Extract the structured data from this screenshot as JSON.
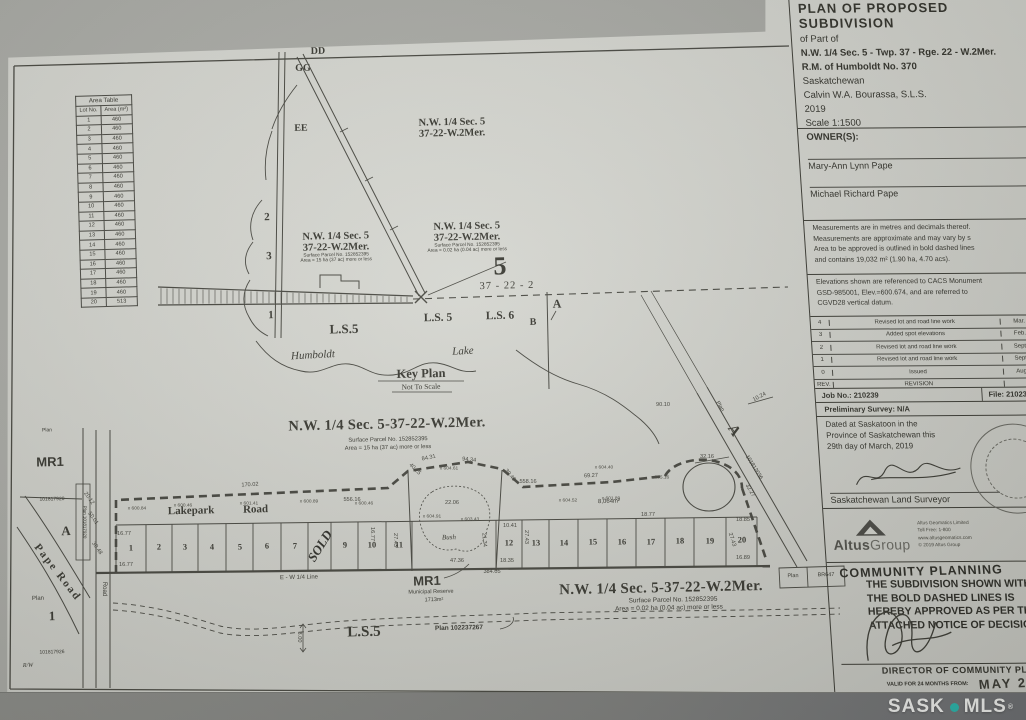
{
  "photo": {
    "watermark_sask": "SASK",
    "watermark_mls": "MLS",
    "watermark_reg": "®"
  },
  "area_table": {
    "title": "Area Table",
    "col_lot": "Lot No.",
    "col_area": "Area (m²)",
    "rows": [
      [
        "1",
        "460"
      ],
      [
        "2",
        "460"
      ],
      [
        "3",
        "460"
      ],
      [
        "4",
        "460"
      ],
      [
        "5",
        "460"
      ],
      [
        "6",
        "460"
      ],
      [
        "7",
        "460"
      ],
      [
        "8",
        "460"
      ],
      [
        "9",
        "460"
      ],
      [
        "10",
        "460"
      ],
      [
        "11",
        "460"
      ],
      [
        "12",
        "460"
      ],
      [
        "13",
        "460"
      ],
      [
        "14",
        "460"
      ],
      [
        "15",
        "460"
      ],
      [
        "16",
        "460"
      ],
      [
        "17",
        "460"
      ],
      [
        "18",
        "460"
      ],
      [
        "19",
        "460"
      ],
      [
        "20",
        "513"
      ]
    ]
  },
  "key_plan": {
    "dd": "DD",
    "gg": "GG",
    "ee": "EE",
    "n2": "2",
    "n3": "3",
    "n1": "1",
    "q_upper": [
      "N.W. 1/4 Sec. 5",
      "37-22-W.2Mer."
    ],
    "q_left": [
      "N.W. 1/4 Sec. 5",
      "37-22-W.2Mer.",
      "Surface Parcel No. 152852395",
      "Area = 15 ha (37 ac) more or less"
    ],
    "q_right": [
      "N.W. 1/4 Sec. 5",
      "37-22-W.2Mer.",
      "Surface Parcel No. 152852395",
      "Area = 0.02 ha (0.04 ac) more or less"
    ],
    "sec5": "5",
    "sec5_sub": "37 - 22 - 2",
    "ls5_big": "L.S.5",
    "ls5": "L.S. 5",
    "ls6": "L.S. 6",
    "b": "B",
    "a": "A",
    "humboldt": "Humboldt",
    "lake": "Lake",
    "title": "Key Plan",
    "subtitle": "Not To Scale"
  },
  "main_plan": {
    "heading": [
      "N.W. 1/4 Sec. 5-37-22-W.2Mer.",
      "Surface Parcel No. 152852395",
      "Area = 15 ha (37 ac) more or less"
    ],
    "road_name": "Lakepark Road",
    "mr1": "MR1",
    "mr1_sub": "Municipal Reserve",
    "mr1_area": "1713m²",
    "bush": "Bush",
    "area_8064": "8,064m²",
    "ew_line": "E - W 1/4 Line",
    "heading2": [
      "N.W. 1/4 Sec. 5-37-22-W.2Mer.",
      "Surface Parcel No. 152852395",
      "Area = 0.02 ha (0.04 ac) more or less"
    ],
    "plan_ref": "Plan 102237267",
    "ls5": "L.S.5",
    "west": {
      "plan_top": "Plan",
      "mr1": "MR1",
      "plan_no_1": "101817920",
      "a": "A",
      "pape_road": "Pape Road",
      "plan_word": "Plan",
      "lot1": "1",
      "plan_no_2": "101817926",
      "rw": "R/W",
      "plan_strip": "Plan 101817920",
      "road_word": "Road"
    },
    "east": {
      "a": "A",
      "plan_no": "101812036",
      "plan_word": "Plan",
      "plan_box_1": "Plan",
      "plan_box_2": "BR647"
    },
    "lots": {
      "west_edges": [
        116,
        146,
        172,
        198,
        226,
        253,
        281,
        308,
        331,
        358,
        386,
        412
      ],
      "west_labels": [
        "1",
        "2",
        "3",
        "4",
        "5",
        "6",
        "7",
        "SOLD",
        "9",
        "10",
        "11"
      ],
      "east_edges": [
        496,
        522,
        549,
        578,
        607,
        636,
        665,
        694,
        726,
        757
      ],
      "east_labels": [
        "12",
        "13",
        "14",
        "15",
        "16",
        "17",
        "18",
        "19",
        "20"
      ],
      "sold_label": "SOLD"
    },
    "dims": [
      {
        "t": "170.02",
        "x": 250,
        "y": 486,
        "r": -3
      },
      {
        "t": "84.31",
        "x": 429,
        "y": 459,
        "r": -12
      },
      {
        "t": "94.34",
        "x": 469,
        "y": 461,
        "r": 6
      },
      {
        "t": "40.25",
        "x": 414,
        "y": 470,
        "r": 45
      },
      {
        "t": "39.40",
        "x": 509,
        "y": 476,
        "r": 50
      },
      {
        "t": "22.06",
        "x": 452,
        "y": 504,
        "r": 0
      },
      {
        "t": "69.27",
        "x": 591,
        "y": 477,
        "r": -2
      },
      {
        "t": "556.16",
        "x": 352,
        "y": 501,
        "r": 0
      },
      {
        "t": "558.16",
        "x": 528,
        "y": 483,
        "r": 0
      },
      {
        "t": "16.77",
        "x": 124,
        "y": 535,
        "r": 0
      },
      {
        "t": "16.77",
        "x": 126,
        "y": 566,
        "r": 0
      },
      {
        "t": "16.77",
        "x": 371,
        "y": 534,
        "r": 90
      },
      {
        "t": "18.77",
        "x": 648,
        "y": 516,
        "r": 0
      },
      {
        "t": "27.43",
        "x": 394,
        "y": 540,
        "r": 90
      },
      {
        "t": "27.43",
        "x": 525,
        "y": 537,
        "r": 90
      },
      {
        "t": "27.43",
        "x": 731,
        "y": 540,
        "r": 72
      },
      {
        "t": "10.41",
        "x": 510,
        "y": 527,
        "r": 0
      },
      {
        "t": "18.35",
        "x": 507,
        "y": 562,
        "r": 0
      },
      {
        "t": "21.34",
        "x": 483,
        "y": 540,
        "r": 85
      },
      {
        "t": "47.36",
        "x": 457,
        "y": 562,
        "r": 0
      },
      {
        "t": "384.05",
        "x": 492,
        "y": 573,
        "r": 0
      },
      {
        "t": "18.85",
        "x": 743,
        "y": 521,
        "r": 0
      },
      {
        "t": "16.89",
        "x": 743,
        "y": 559,
        "r": 0
      },
      {
        "t": "10.24",
        "x": 760,
        "y": 398,
        "r": -28
      },
      {
        "t": "90.10",
        "x": 663,
        "y": 406,
        "r": 0
      },
      {
        "t": "32.16",
        "x": 707,
        "y": 458,
        "r": 0
      },
      {
        "t": "32.27",
        "x": 749,
        "y": 491,
        "r": 60
      },
      {
        "t": "3.00",
        "x": 298,
        "y": 637,
        "r": 90
      },
      {
        "t": "20.12",
        "x": 88,
        "y": 499,
        "r": 55
      },
      {
        "t": "50.01",
        "x": 92,
        "y": 519,
        "r": 55
      },
      {
        "t": "30.48",
        "x": 96,
        "y": 549,
        "r": 55
      }
    ],
    "spots": [
      {
        "t": "600.84",
        "x": 137,
        "y": 509
      },
      {
        "t": "600.46",
        "x": 183,
        "y": 506
      },
      {
        "t": "601.41",
        "x": 249,
        "y": 504
      },
      {
        "t": "600.89",
        "x": 309,
        "y": 502
      },
      {
        "t": "600.46",
        "x": 364,
        "y": 504
      },
      {
        "t": "604.61",
        "x": 449,
        "y": 469
      },
      {
        "t": "604.91",
        "x": 432,
        "y": 517
      },
      {
        "t": "603.43",
        "x": 470,
        "y": 520
      },
      {
        "t": "604.52",
        "x": 568,
        "y": 501
      },
      {
        "t": "601.89",
        "x": 611,
        "y": 499
      },
      {
        "t": "605.16",
        "x": 660,
        "y": 478
      },
      {
        "t": "604.40",
        "x": 604,
        "y": 468
      }
    ]
  },
  "title_block": {
    "title_lines": [
      "PLAN OF PROPOSED SUBDIVISION",
      "of Part of",
      "N.W. 1/4 Sec. 5 - Twp. 37 - Rge. 22 - W.2Mer.",
      "R.M. of Humboldt No. 370",
      "Saskatchewan",
      "Calvin W.A. Bourassa, S.L.S.",
      "2019",
      "Scale 1:1500"
    ],
    "owners_label": "OWNER(S):",
    "owners": [
      "Mary-Ann Lynn Pape",
      "Michael Richard Pape"
    ],
    "notes": [
      "Measurements are in metres and decimals thereof.",
      "Measurements are approximate and may vary by s",
      "Area to be approved is outlined in bold dashed lines",
      "and contains 19,032 m² (1.90 ha, 4.70 acs)."
    ],
    "elev_note": [
      "Elevations shown are referenced to CACS Monument",
      "GSD-985001, Elev.=600.674, and are referred to",
      "CGVD28 vertical datum."
    ],
    "revision_table": {
      "headers": [
        "REV.",
        "REVISION",
        "DATE"
      ],
      "rows": [
        [
          "4",
          "Revised lot and road line work",
          "Mar. 29, 2019"
        ],
        [
          "3",
          "Added spot elevations",
          "Feb. 14, 2019"
        ],
        [
          "2",
          "Revised lot and road line work",
          "Sept. 27, 2018"
        ],
        [
          "1",
          "Revised lot and road line work",
          "Sept. 10, 2018"
        ],
        [
          "0",
          "Issued",
          "Aug. 27, 2018"
        ]
      ]
    },
    "job_no": "Job No.: 210239",
    "file_no": "File: 210239PR-A-R4",
    "preliminary": "Preliminary Survey: N/A",
    "dated_lines": [
      "Dated at Saskatoon in the",
      "Province of Saskatchewan this",
      "29th day of March, 2019"
    ],
    "surveyor_label": "Saskatchewan Land Surveyor",
    "altus": {
      "name_bold": "Altus",
      "name_light": "Group",
      "right_lines": [
        "Altus Geomatics Limited",
        "Toll Free: 1-800",
        "www.altusgeomatics.com",
        "© 2019 Altus Group"
      ]
    },
    "approval": {
      "stamp": "COMMUNITY PLANNING",
      "lines": [
        "THE SUBDIVISION SHOWN WITHIN",
        "THE BOLD DASHED LINES IS",
        "HEREBY APPROVED AS PER THE",
        "ATTACHED NOTICE OF DECISION"
      ],
      "director": "DIRECTOR OF COMMUNITY PLANNING",
      "valid_label": "VALID FOR 24 MONTHS FROM:",
      "valid_date": "MAY 27"
    }
  }
}
